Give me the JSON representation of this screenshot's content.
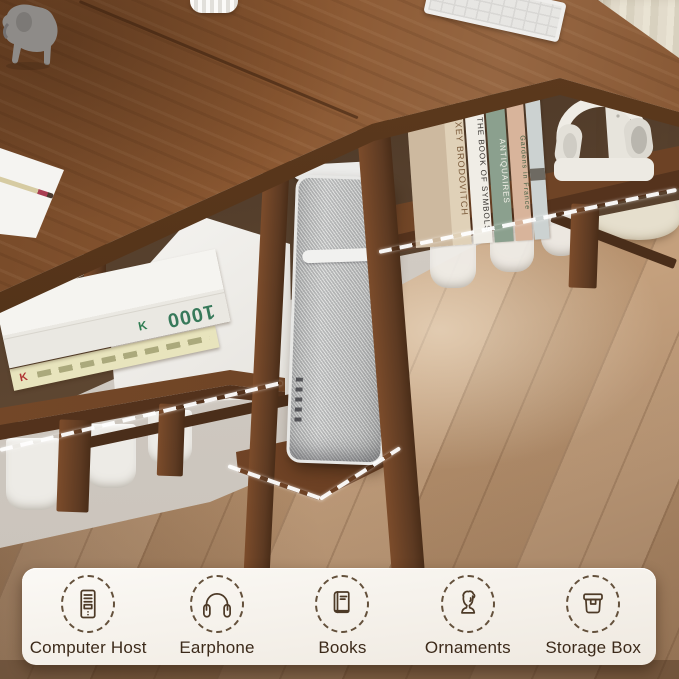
{
  "banner": {
    "items": [
      {
        "label": "Computer Host",
        "icon": "computer-host"
      },
      {
        "label": "Earphone",
        "icon": "earphone"
      },
      {
        "label": "Books",
        "icon": "books"
      },
      {
        "label": "Ornaments",
        "icon": "ornaments"
      },
      {
        "label": "Storage Box",
        "icon": "storage-box"
      }
    ]
  },
  "scene": {
    "right_shelf_books": [
      "ALEXEY BRODOVITCH",
      "THE BOOK OF SYMBOLS",
      "ANTIQUAIRES",
      "Gardens in France"
    ],
    "left_stack_books": {
      "top_book_number": "1000",
      "publisher_mark": "K"
    },
    "colors": {
      "desk_wood": "#8a5731",
      "floor": "#c09a75",
      "curtain": "#e0d9c8",
      "tower_silver": "#c6c7c5",
      "banner_bg": "#f7f3ec",
      "banner_text": "#3c2a1a",
      "icon_line": "#4d3a27",
      "highlight_dash": "#ffffff"
    }
  }
}
